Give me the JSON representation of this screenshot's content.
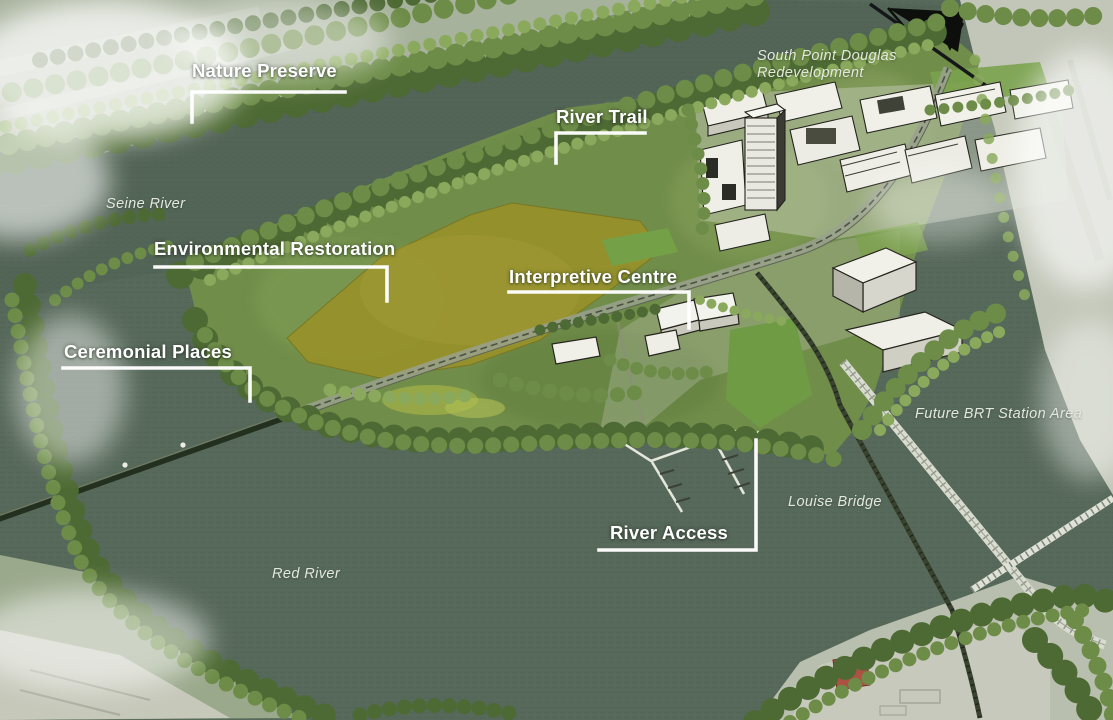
{
  "map": {
    "title": "Riverfront master plan aerial rendering",
    "callouts": {
      "nature_preserve": "Nature Preserve",
      "river_trail": "River Trail",
      "environmental_restoration": "Environmental Restoration",
      "interpretive_centre": "Interpretive Centre",
      "ceremonial_places": "Ceremonial Places",
      "river_access": "River Access"
    },
    "places": {
      "south_point_douglas_line1": "South Point Douglas",
      "south_point_douglas_line2": "Redevelopment",
      "seine_river": "Seine River",
      "red_river": "Red River",
      "louise_bridge": "Louise Bridge",
      "future_brt_station": "Future BRT Station Area"
    },
    "colors": {
      "river_water": "#57695a",
      "meadow_yellow": "#96922d",
      "tree_canopy_dark": "#4e6a34",
      "tree_canopy_mid": "#6d8c48",
      "tree_canopy_light": "#8aa95c",
      "lawn_green": "#6f9b44",
      "building_fill": "#f2f2ea",
      "building_outline": "#26261f",
      "callout_text": "#ffffff",
      "leader_line": "#ffffff",
      "place_text": "#e3e8de",
      "mist_white": "#ffffff"
    }
  }
}
